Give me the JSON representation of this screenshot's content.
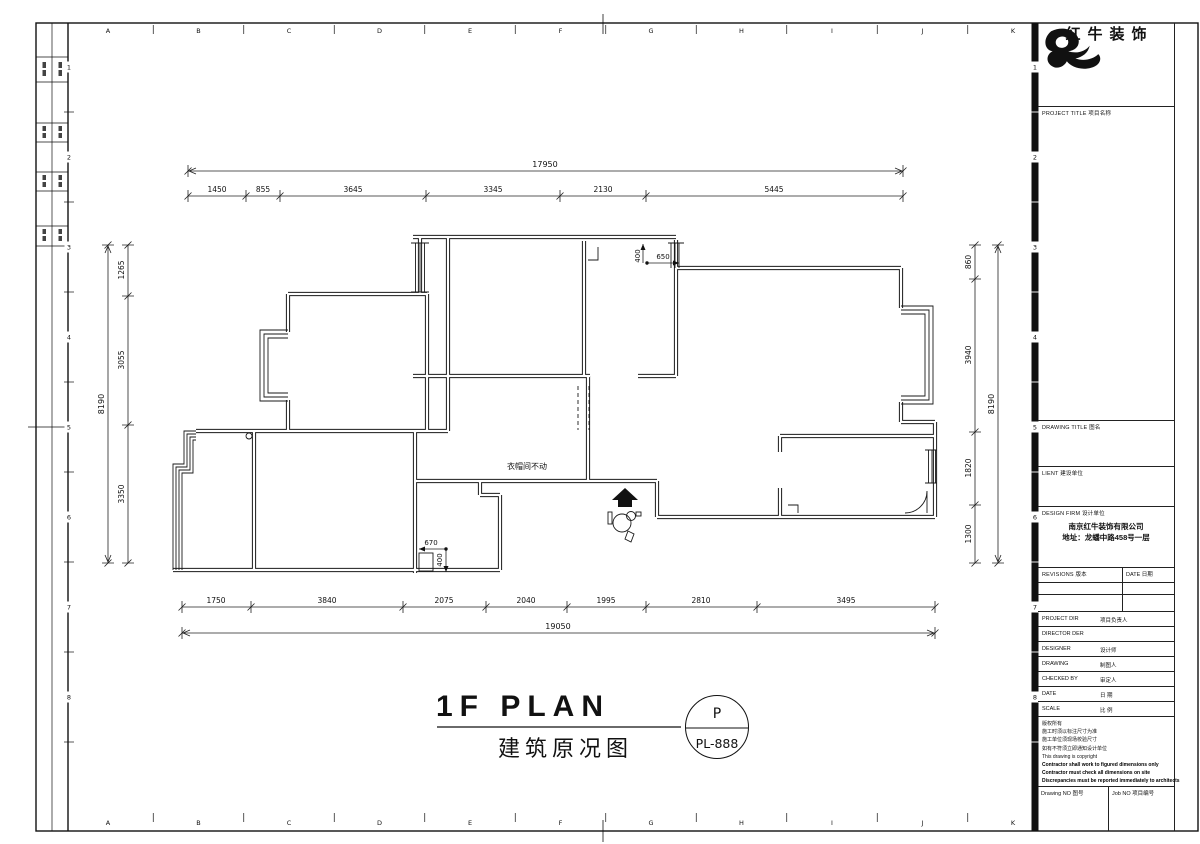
{
  "sheet": {
    "grid_letters": [
      "A",
      "B",
      "C",
      "D",
      "E",
      "F",
      "G",
      "H",
      "I",
      "J",
      "K"
    ],
    "grid_numbers": [
      "1",
      "2",
      "3",
      "4",
      "5",
      "6",
      "7",
      "8"
    ]
  },
  "title_block": {
    "logo_text": "红牛装饰",
    "project_title_label": "PROJECT TITLE  项目名称",
    "drawing_title_label": "DRAWING TITLE  图名",
    "client_label": "LIENT  建设单位",
    "design_firm_label": "DESIGN FIRM  设计单位",
    "design_firm_name": "南京红牛装饰有限公司",
    "design_firm_address": "地址：龙蟠中路458号一层",
    "revisions_label": "REVISIONS  版本",
    "date_col_label": "DATE  日期",
    "rows": [
      {
        "en": "PROJECT DIR",
        "zh": "项目负责人"
      },
      {
        "en": "DIRECTOR DER",
        "zh": ""
      },
      {
        "en": "DESIGNER",
        "zh": "设计师"
      },
      {
        "en": "DRAWING",
        "zh": "制图人"
      },
      {
        "en": "CHECKED BY",
        "zh": "审定人"
      },
      {
        "en": "DATE",
        "zh": "日  期"
      },
      {
        "en": "SCALE",
        "zh": "比  例"
      }
    ],
    "copyright_lines": [
      "版权所有",
      "施工时须以标注尺寸为准",
      "施工单位须现场校验尺寸",
      "如有不符须立即通知设计单位",
      "This drawing is copyright",
      "Contractor shall work to figured dimensions only",
      "Contractor must check all dimensions on site",
      "Discrepancies must be reported immediately to architects"
    ],
    "drawing_no_label": "Drawing NO  图号",
    "job_no_label": "Job NO  项目编号"
  },
  "plan": {
    "dims": {
      "top_total": "17950",
      "top": [
        "1450",
        "855",
        "3645",
        "3345",
        "2130",
        "5445"
      ],
      "bottom": [
        "1750",
        "3840",
        "2075",
        "2040",
        "1995",
        "2810",
        "3495"
      ],
      "bottom_total": "19050",
      "left": [
        "1265",
        "3055",
        "3350"
      ],
      "left_total": "8190",
      "right": [
        "860",
        "3940",
        "1820",
        "1300"
      ],
      "right_total": "8190",
      "inline": [
        "400",
        "650",
        "670",
        "400"
      ]
    },
    "note": "衣帽间不动"
  },
  "footer": {
    "title_en": "1F PLAN",
    "title_zh": "建筑原况图",
    "stamp_top": "P",
    "stamp_bottom": "PL-888"
  }
}
